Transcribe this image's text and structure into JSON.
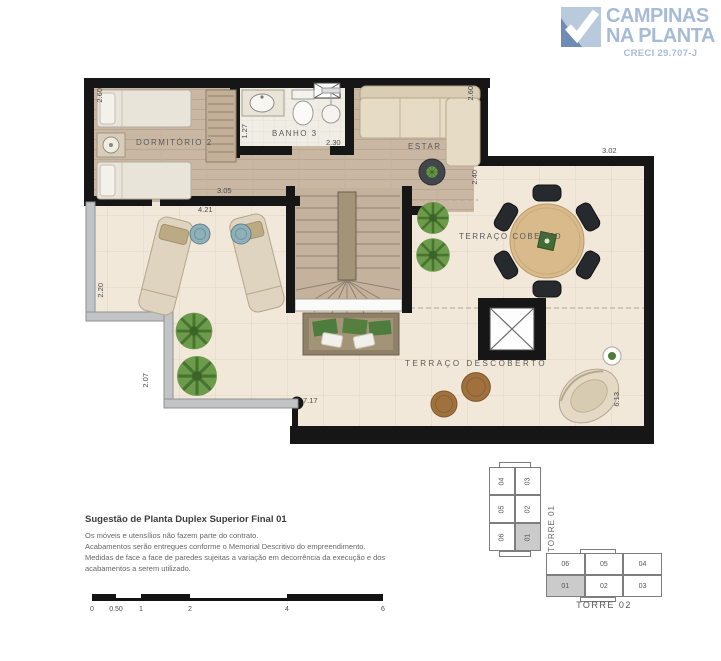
{
  "logo": {
    "name_line1": "CAMPINAS",
    "name_line2": "NA PLANTA",
    "creci": "CRECI 29.707-J"
  },
  "plan": {
    "rooms": {
      "dormitorio2": "DORMITÓRIO 2",
      "banho3": "BANHO 3",
      "estar": "ESTAR",
      "terraco_coberto": "TERRAÇO COBERTO",
      "terraco_descoberto": "TERRAÇO DESCOBERTO"
    },
    "dimensions": {
      "dorm_top_left_v": "2.60",
      "dorm_width": "4.21",
      "dorm_inner": "3.05",
      "closet_v": "1.27",
      "banho_width": "2.30",
      "estar_top_right_v": "2.60",
      "estar_right_v": "2.40",
      "terraco_top": "3.02",
      "terrace_left_v": "2.20",
      "terrace_left_lower_v": "2.07",
      "terrace_bottom": "7.17",
      "terrace_right_v": "6.13"
    }
  },
  "notes": {
    "title": "Sugestão de Planta Duplex Superior Final 01",
    "lines": [
      "Os móveis e utensílios não fazem parte do contrato.",
      "Acabamentos serão entregues conforme o Memorial Descritivo do empreendimento.",
      "Medidas de face a face de paredes sujeitas a variação em decorrência da execução e dos",
      "acabamentos a serem utilizado."
    ]
  },
  "scalebar": {
    "labels": [
      "0",
      "0.50",
      "1",
      "2",
      "4",
      "6"
    ]
  },
  "towers": {
    "torre01": {
      "label": "TORRE 01",
      "units": [
        "04",
        "03",
        "05",
        "02",
        "06",
        "01"
      ],
      "highlighted_unit": "01"
    },
    "torre02": {
      "label": "TORRE 02",
      "units_top": [
        "06",
        "05",
        "04"
      ],
      "units_bottom": [
        "01",
        "02",
        "03"
      ],
      "highlighted_unit": "01"
    }
  },
  "colors": {
    "logo_blue": "#a6bcd6",
    "wall_black": "#161616",
    "wood_floor": "#c9b7a3",
    "tile_floor": "#f2e8d9",
    "plant_green": "#6b9b4b",
    "highlight_gray": "#cbcbcb"
  }
}
